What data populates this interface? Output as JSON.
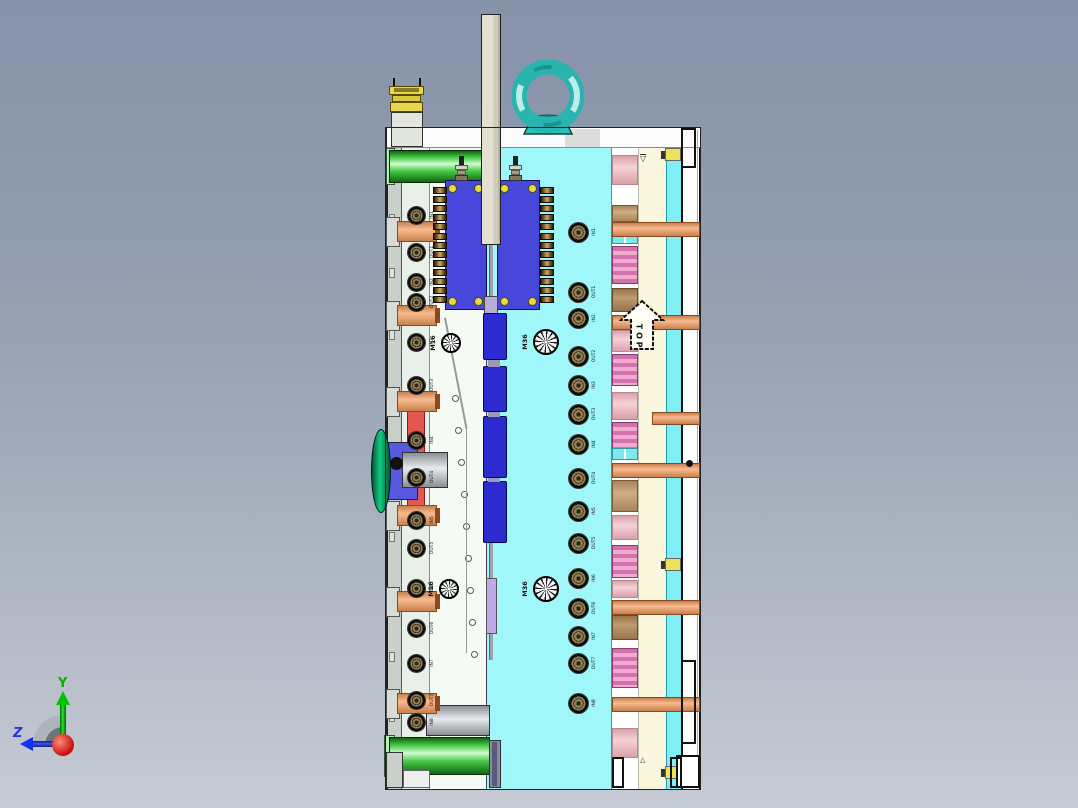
{
  "orientation_arrow": {
    "label": "TOP",
    "letters": [
      "T",
      "O",
      "P"
    ]
  },
  "triad": {
    "y_label": "Y",
    "z_label": "Z"
  },
  "datum_marks": {
    "upper": "▽",
    "lower": "△"
  },
  "plug_marks": [
    {
      "label": "M16",
      "cx": 451,
      "cy": 343,
      "r": 10
    },
    {
      "label": "M16",
      "cx": 449,
      "cy": 589,
      "r": 10
    },
    {
      "label": "M36",
      "cx": 546,
      "cy": 342,
      "r": 13
    },
    {
      "label": "M36",
      "cx": 546,
      "cy": 589,
      "r": 13
    }
  ],
  "cooling_ports": {
    "right": {
      "items": [
        {
          "label": "IN1",
          "y": 232
        },
        {
          "label": "OUT1",
          "y": 292
        },
        {
          "label": "IN2",
          "y": 318
        },
        {
          "label": "OUT2",
          "y": 356
        },
        {
          "label": "IN3",
          "y": 385
        },
        {
          "label": "OUT3",
          "y": 414
        },
        {
          "label": "IN4",
          "y": 444
        },
        {
          "label": "OUT4",
          "y": 478
        },
        {
          "label": "IN5",
          "y": 511
        },
        {
          "label": "OUT5",
          "y": 543
        },
        {
          "label": "IN6",
          "y": 578
        },
        {
          "label": "OUT6",
          "y": 608
        },
        {
          "label": "IN7",
          "y": 636
        },
        {
          "label": "OUT7",
          "y": 663
        },
        {
          "label": "IN8",
          "y": 703
        }
      ]
    },
    "left": {
      "items": [
        {
          "label": "IN1",
          "y": 215
        },
        {
          "label": "OUT1",
          "y": 252
        },
        {
          "label": "IN2",
          "y": 282
        },
        {
          "label": "OUT2",
          "y": 302
        },
        {
          "label": "IN3",
          "y": 342
        },
        {
          "label": "OUT3",
          "y": 385
        },
        {
          "label": "IN4",
          "y": 440
        },
        {
          "label": "OUT4",
          "y": 477
        },
        {
          "label": "IN5",
          "y": 520
        },
        {
          "label": "OUT5",
          "y": 548
        },
        {
          "label": "IN6",
          "y": 588
        },
        {
          "label": "OUT6",
          "y": 628
        },
        {
          "label": "IN7",
          "y": 663
        },
        {
          "label": "OUT7",
          "y": 700
        },
        {
          "label": "IN8",
          "y": 722
        }
      ]
    }
  },
  "colors": {
    "background_top": "#8692A8",
    "background_bottom": "#C6CBD4",
    "main_plate_cyan": "#9FF7F9",
    "secondary_cyan": "#7FEFF4",
    "cream_strip": "#FBF6DE",
    "white_plate": "#F5FAF5",
    "gray_plate": "#C9CFC9",
    "blue_block": "#4747DC",
    "nozzle_blue": "#2B2BD0",
    "green_cylinder": "#45C845",
    "teal_eyebolt": "#29B4B0",
    "beige_bar": "#E3E0D1",
    "yellow_fitting": "#E6D84E",
    "salmon_pin": "#F2A87E",
    "tan_cylinder": "#D2AE85",
    "pink_cylinder": "#F7D2D9",
    "magenta_spring": "#D172AC",
    "screw_bronze": "#95835A",
    "axis_y_green": "#00C400",
    "axis_z_blue": "#2038E8",
    "origin_red": "#E01010"
  }
}
